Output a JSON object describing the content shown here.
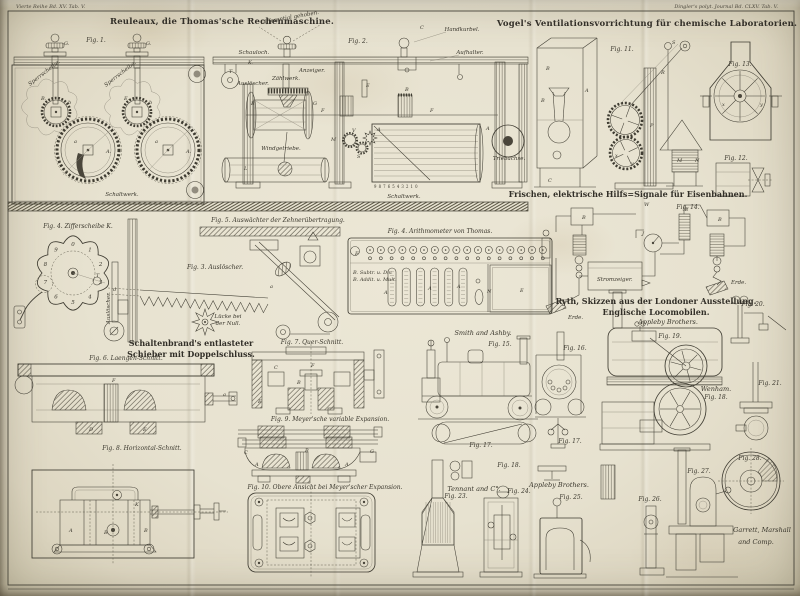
{
  "plate": {
    "margins": {
      "left": "Vierte Reihe Bd. XV. Tab. V.",
      "right": "Dingler's polyt. Journal Bd. CLXV. Tab. V."
    },
    "sections": {
      "rechenmaschine_title": "Reuleaux, die Thomas'sche Rechenmaschine.",
      "ventilation_title": "Vogel's Ventilationsvorrichtung für chemische Laboratorien.",
      "signale_title": "Frischen, elektrische Hilfs=Signale für Eisenbahnen.",
      "locomobilen_title_1": "Ryth, Skizzen aus der Londoner Ausstellung.",
      "locomobilen_title_2": "Englische Locomobilen.",
      "schieber_title_1": "Schaltenbrand's entlasteter",
      "schieber_title_2": "Schieber mit Doppelschluss."
    },
    "figure_labels": {
      "fig_left": "Fig. 1.",
      "fig_mid": "Fig. 2.",
      "fig_plan": "Fig. 4. Arithmometer von Thomas.",
      "fig_ziffer": "Fig. 4. Zifferscheibe K.",
      "fig_3": "Fig. 3. Auslöscher.",
      "fig_5": "Fig. 5. Auswächter der Zehnerübertragung.",
      "fig_6": "Fig. 6. Laengen-Schnitt.",
      "fig_7": "Fig. 7. Quer-Schnitt.",
      "fig_8": "Fig. 8. Horizontal-Schnitt.",
      "fig_9": "Fig. 9. Meyer'sche variable Expansion.",
      "fig_10": "Fig. 10. Obere Ansicht bei Meyer'scher Expansion.",
      "fig_11": "Fig. 11.",
      "fig_12": "Fig. 12.",
      "fig_13": "Fig. 13.",
      "fig_14": "Fig. 14.",
      "fig_15": "Fig. 15.",
      "fig_16": "Fig. 16.",
      "fig_17a": "Fig. 17.",
      "fig_17b": "Fig. 17.",
      "fig_18a": "Fig. 18.",
      "fig_18b": "Fig. 18.",
      "fig_19": "Fig. 19.",
      "fig_20": "Fig. 20.",
      "fig_21": "Fig. 21.",
      "fig_23": "Fig. 23.",
      "fig_24": "Fig. 24.",
      "fig_25": "Fig. 25.",
      "fig_26": "Fig. 26.",
      "fig_27": "Fig. 27.",
      "fig_28": "Fig. 28."
    },
    "part_labels": {
      "sperrscheibe_1": "Sperrscheibe.",
      "sperrscheibe_2": "Sperrscheibe.",
      "schaltwerk_left": "Schaltwerk.",
      "schaltwerk_mid": "Schaltwerk.",
      "differential": "Differential gehoben.",
      "schauloch": "Schauloch.",
      "zaehlwerk": "Zählwerk.",
      "ausloescher_mid": "Auslöscher.",
      "anzeiger": "Anzeiger.",
      "windgetriebe": "Windgetriebe.",
      "handkurbel": "Handkurbel.",
      "aufhalter": "Aufhalter.",
      "triebachse": "Triebachse.",
      "ausloescher_vert": "Auslöscher.",
      "luecke_1": "Lücke bei",
      "luecke_2": "der Null.",
      "subtr": "B. Subtr. u. Div.",
      "addit": "B. Addit. u. Mult.",
      "stromzeiger": "Stromzeiger.",
      "erde_1": "Erde.",
      "erde_2": "Erde.",
      "drum_digits": "9 8 7 6 5 4 3 2 1 0"
    },
    "makers": {
      "smith_ashby": "Smith and Ashby.",
      "appleby_1": "Appleby Brothers.",
      "appleby_2": "Appleby Brothers.",
      "tennant": "Tennant and C°.",
      "garrett_1": "Garrett, Marshall",
      "garrett_2": "and Comp.",
      "wenham": "Wenham."
    },
    "dial_digits": [
      "1",
      "2",
      "3",
      "4",
      "5",
      "6",
      "7",
      "8",
      "9",
      "0"
    ],
    "letters": [
      {
        "t": "G.",
        "x": 64,
        "y": 45
      },
      {
        "t": "G.",
        "x": 146,
        "y": 45
      },
      {
        "t": "B.",
        "x": 41,
        "y": 100
      },
      {
        "t": "E.",
        "x": 124,
        "y": 100
      },
      {
        "t": "b",
        "x": 68,
        "y": 104
      },
      {
        "t": "b",
        "x": 149,
        "y": 104
      },
      {
        "t": "A.",
        "x": 106,
        "y": 153
      },
      {
        "t": "A.",
        "x": 186,
        "y": 153
      },
      {
        "t": "a",
        "x": 74,
        "y": 143
      },
      {
        "t": "a",
        "x": 155,
        "y": 143
      },
      {
        "t": "T",
        "x": 229,
        "y": 73
      },
      {
        "t": "K.",
        "x": 248,
        "y": 64
      },
      {
        "t": "B",
        "x": 251,
        "y": 105
      },
      {
        "t": "G",
        "x": 313,
        "y": 105
      },
      {
        "t": "F",
        "x": 321,
        "y": 112
      },
      {
        "t": "F",
        "x": 430,
        "y": 112
      },
      {
        "t": "M",
        "x": 331,
        "y": 141
      },
      {
        "t": "L",
        "x": 244,
        "y": 170
      },
      {
        "t": "V",
        "x": 352,
        "y": 132
      },
      {
        "t": "E",
        "x": 366,
        "y": 87
      },
      {
        "t": "B",
        "x": 405,
        "y": 91
      },
      {
        "t": "A",
        "x": 377,
        "y": 131
      },
      {
        "t": "A",
        "x": 486,
        "y": 130
      },
      {
        "t": "S",
        "x": 357,
        "y": 158
      },
      {
        "t": "C",
        "x": 420,
        "y": 29
      },
      {
        "t": "W",
        "x": 644,
        "y": 206
      },
      {
        "t": "B",
        "x": 546,
        "y": 70
      },
      {
        "t": "B",
        "x": 541,
        "y": 102
      },
      {
        "t": "A",
        "x": 585,
        "y": 92
      },
      {
        "t": "C",
        "x": 548,
        "y": 182
      },
      {
        "t": "P",
        "x": 650,
        "y": 127
      },
      {
        "t": "R",
        "x": 661,
        "y": 74
      },
      {
        "t": "S",
        "x": 672,
        "y": 44
      },
      {
        "t": "M",
        "x": 677,
        "y": 162
      },
      {
        "t": "N",
        "x": 695,
        "y": 162
      },
      {
        "t": "x",
        "x": 615,
        "y": 157
      },
      {
        "t": "y",
        "x": 631,
        "y": 165
      },
      {
        "t": "x",
        "x": 722,
        "y": 106
      },
      {
        "t": "y",
        "x": 760,
        "y": 106
      },
      {
        "t": "B",
        "x": 582,
        "y": 219
      },
      {
        "t": "B",
        "x": 718,
        "y": 221
      },
      {
        "t": "E",
        "x": 685,
        "y": 211
      },
      {
        "t": "J",
        "x": 642,
        "y": 235
      },
      {
        "t": "F",
        "x": 355,
        "y": 255
      },
      {
        "t": "E",
        "x": 520,
        "y": 292
      },
      {
        "t": "N",
        "x": 487,
        "y": 293
      },
      {
        "t": "A",
        "x": 384,
        "y": 294
      },
      {
        "t": "A",
        "x": 428,
        "y": 290
      },
      {
        "t": "A",
        "x": 457,
        "y": 288
      },
      {
        "t": "T",
        "x": 96,
        "y": 277
      },
      {
        "t": "F",
        "x": 112,
        "y": 382
      },
      {
        "t": "D",
        "x": 89,
        "y": 431
      },
      {
        "t": "E",
        "x": 143,
        "y": 431
      },
      {
        "t": "a",
        "x": 223,
        "y": 396
      },
      {
        "t": "C",
        "x": 274,
        "y": 369
      },
      {
        "t": "F",
        "x": 311,
        "y": 367
      },
      {
        "t": "B",
        "x": 297,
        "y": 384
      },
      {
        "t": "E",
        "x": 258,
        "y": 403
      },
      {
        "t": "A",
        "x": 69,
        "y": 532
      },
      {
        "t": "B",
        "x": 104,
        "y": 534
      },
      {
        "t": "B",
        "x": 144,
        "y": 532
      },
      {
        "t": "K",
        "x": 135,
        "y": 506
      },
      {
        "t": "C",
        "x": 244,
        "y": 454
      },
      {
        "t": "A",
        "x": 255,
        "y": 466
      },
      {
        "t": "A",
        "x": 345,
        "y": 466
      },
      {
        "t": "B",
        "x": 305,
        "y": 452
      },
      {
        "t": "G",
        "x": 370,
        "y": 453
      },
      {
        "t": "a",
        "x": 270,
        "y": 288
      },
      {
        "t": "d",
        "x": 113,
        "y": 291
      }
    ]
  },
  "colors": {
    "paper": "#e8e3d1",
    "paper_edge": "#c8c1a8",
    "ink": "#3f3c32",
    "ink_light": "#8a8577",
    "stain": "#b89b6a"
  }
}
